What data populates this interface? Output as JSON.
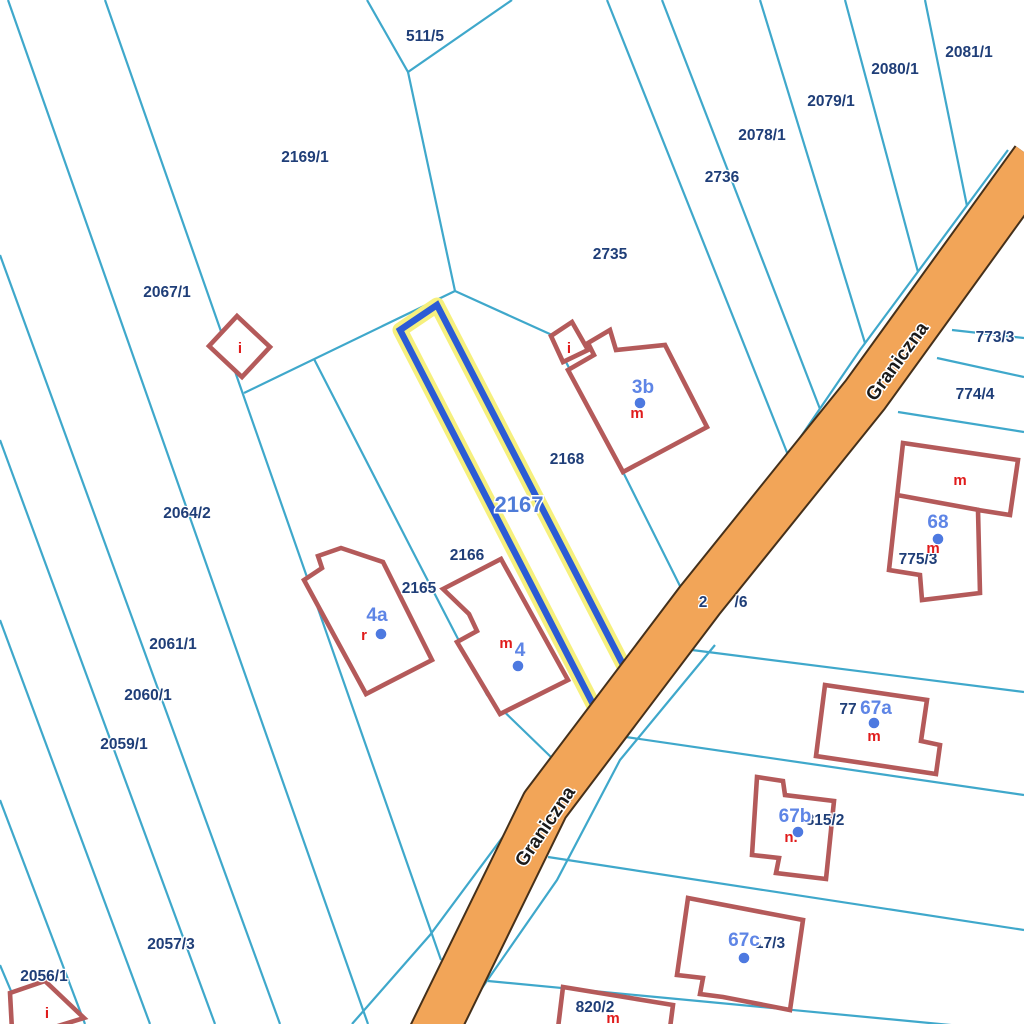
{
  "map": {
    "type": "cadastral-parcel-map",
    "street": {
      "name": "Graniczna"
    },
    "street_labels": [
      {
        "text": "Graniczna"
      },
      {
        "text": "Graniczna"
      }
    ],
    "highlighted_parcel": {
      "number": "2167",
      "highlight_color": "#F6F07E",
      "border_color": "#2B5BD5"
    },
    "parcel_labels": [
      {
        "text": "511/5"
      },
      {
        "text": "2169/1"
      },
      {
        "text": "2067/1"
      },
      {
        "text": "2064/2"
      },
      {
        "text": "2061/1"
      },
      {
        "text": "2060/1"
      },
      {
        "text": "2059/1"
      },
      {
        "text": "2057/3"
      },
      {
        "text": "2056/1"
      },
      {
        "text": "2165"
      },
      {
        "text": "2166"
      },
      {
        "text": "2168"
      },
      {
        "text": "2735"
      },
      {
        "text": "2736"
      },
      {
        "text": "2078/1"
      },
      {
        "text": "2079/1"
      },
      {
        "text": "2080/1"
      },
      {
        "text": "2081/1"
      },
      {
        "text": "773/3"
      },
      {
        "text": "774/4"
      },
      {
        "text": "775/3"
      },
      {
        "text": "815/2"
      },
      {
        "text": "820/2"
      },
      {
        "text": "77"
      },
      {
        "text": "17/3"
      },
      {
        "text": "2"
      },
      {
        "text": "/6"
      }
    ],
    "building_labels": [
      {
        "text": "3b"
      },
      {
        "text": "4a"
      },
      {
        "text": "4"
      },
      {
        "text": "68"
      },
      {
        "text": "67a"
      },
      {
        "text": "67b"
      },
      {
        "text": "67c"
      }
    ],
    "building_type_labels": [
      {
        "text": "m"
      },
      {
        "text": "r"
      },
      {
        "text": "m"
      },
      {
        "text": "m"
      },
      {
        "text": "m"
      },
      {
        "text": "m"
      },
      {
        "text": "n."
      },
      {
        "text": "m"
      },
      {
        "text": "i"
      },
      {
        "text": "i"
      },
      {
        "text": "i"
      }
    ],
    "colors": {
      "boundary_line": "#3FA8CB",
      "road_fill": "#F2A558",
      "road_edge": "#45301A",
      "building_outline": "#B45A5A",
      "highlight_glow": "#F6F07E",
      "highlight_border": "#2B5BD5",
      "parcel_text": "#1F3E78",
      "building_text": "#5E85E6",
      "marker_dot": "#4D79E0",
      "type_text": "#E01B1B",
      "street_text": "#1A1A1A",
      "background": "#FFFFFF"
    }
  }
}
